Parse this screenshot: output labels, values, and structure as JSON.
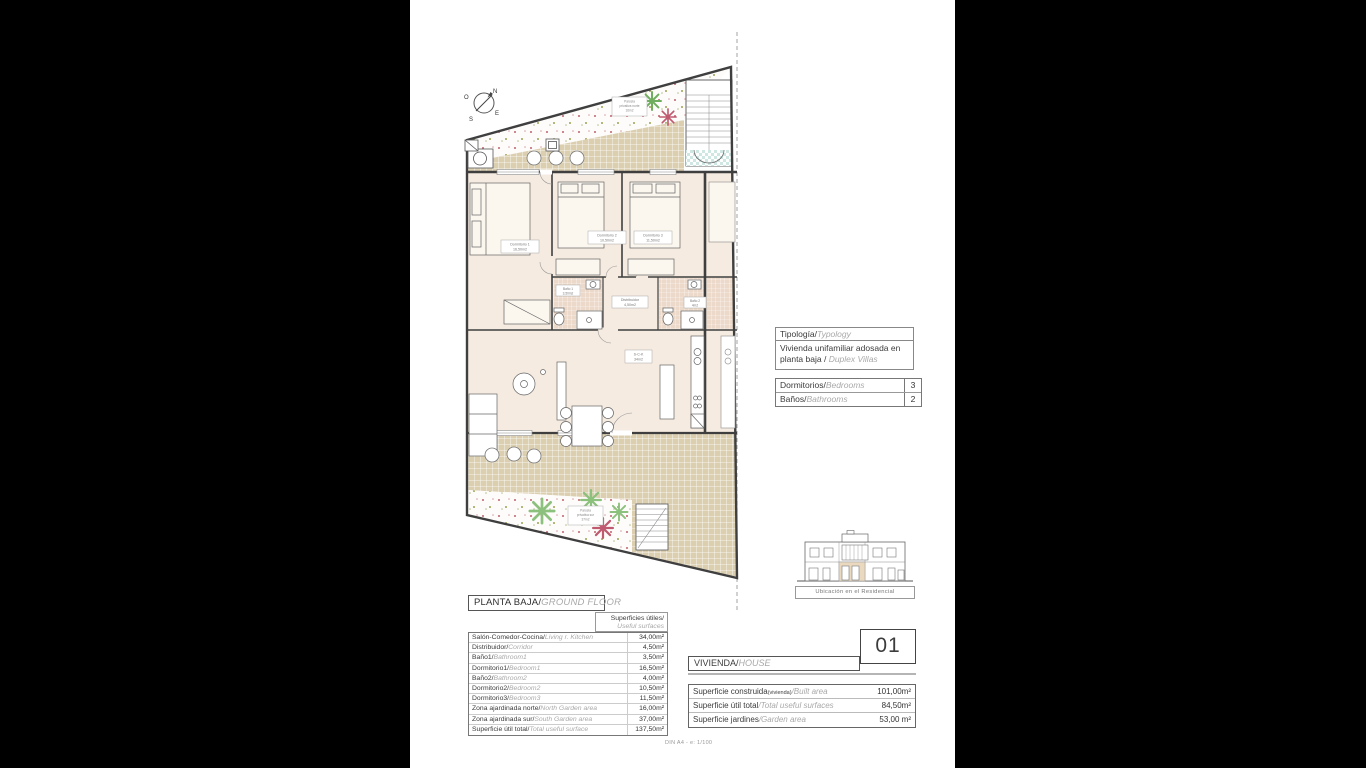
{
  "typology_box": {
    "title_es": "Tipología/",
    "title_en": "Typology",
    "value_es": "Vivienda unifamiliar adosada en planta baja / ",
    "value_en": "Duplex Villas"
  },
  "counts_table": {
    "rows": [
      {
        "label_es": "Dormitorios/",
        "label_en": "Bedrooms",
        "value": "3"
      },
      {
        "label_es": "Baños/",
        "label_en": "Bathrooms",
        "value": "2"
      }
    ]
  },
  "floor_title": {
    "es": "PLANTA BAJA/",
    "en": "GROUND FLOOR"
  },
  "useful_surfaces": {
    "es": "Superficies útiles/",
    "en": "Useful surfaces"
  },
  "surfaces_table": {
    "rows": [
      {
        "es": "Salón-Comedor-Cocina/",
        "en": "Living r. Kitchen",
        "value": "34,00m²"
      },
      {
        "es": "Distribuidor/",
        "en": "Corridor",
        "value": "4,50m²"
      },
      {
        "es": "Baño1/",
        "en": "Bathroom1",
        "value": "3,50m²"
      },
      {
        "es": "Dormitorio1/",
        "en": "Bedroom1",
        "value": "16,50m²"
      },
      {
        "es": "Baño2/",
        "en": "Bathroom2",
        "value": "4,00m²"
      },
      {
        "es": "Dormitorio2/",
        "en": "Bedroom2",
        "value": "10,50m²"
      },
      {
        "es": "Dormitorio3/",
        "en": "Bedroom3",
        "value": "11,50m²"
      },
      {
        "es": "Zona ajardinada norte/",
        "en": "North Garden area",
        "value": "16,00m²"
      },
      {
        "es": "Zona ajardinada sur/",
        "en": "South Garden area",
        "value": "37,00m²"
      },
      {
        "es": "Superficie útil total/",
        "en": "Total useful surface",
        "value": "137,50m²"
      }
    ]
  },
  "unit_box": {
    "number": "01"
  },
  "house_header": {
    "es": "VIVIENDA/",
    "en": "HOUSE"
  },
  "totals_table": {
    "rows": [
      {
        "es": "Superficie construida",
        "es_small": "(vivienda)",
        "en": "/Built area",
        "value": "101,00m²"
      },
      {
        "es": "Superficie útil total",
        "es_small": "",
        "en": "/Total useful surfaces",
        "value": "84,50m²"
      },
      {
        "es": "Superficie jardines",
        "es_small": "",
        "en": "/Garden area",
        "value": "53,00 m²"
      }
    ]
  },
  "location_caption": "Ubicación en el Residencial",
  "scale_note": "DIN A4 - e: 1/100",
  "plan": {
    "compass": {
      "n": "N",
      "s": "S",
      "e": "E",
      "o": "O"
    },
    "room_labels": [
      {
        "name": "Dormitorio 1",
        "area": "16,50m2"
      },
      {
        "name": "Dormitorio 2",
        "area": "10,50m2"
      },
      {
        "name": "Dormitorio 3",
        "area": "11,50m2"
      },
      {
        "name": "Baño 1",
        "area": "3,50m2"
      },
      {
        "name": "Distribuidor",
        "area": "4,50m2"
      },
      {
        "name": "Baño 2",
        "area": "4m2"
      },
      {
        "name": "S-C-K",
        "area": "34m2"
      }
    ],
    "garden_labels": {
      "north": {
        "l1": "Parcela",
        "l2": "privativa norte",
        "l3": "16m2"
      },
      "south": {
        "l1": "Parcela",
        "l2": "privativa sur",
        "l3": "37m2"
      }
    }
  },
  "colors": {
    "room_fill": "#f5ebe0",
    "terrace_fill": "#dccfb0",
    "stair_checker": "#cfe7e2",
    "bath_fill": "#ecd9c9",
    "palm_green": "#79b36a",
    "palm_red": "#c05a70",
    "wall": "#3f3f3f"
  }
}
